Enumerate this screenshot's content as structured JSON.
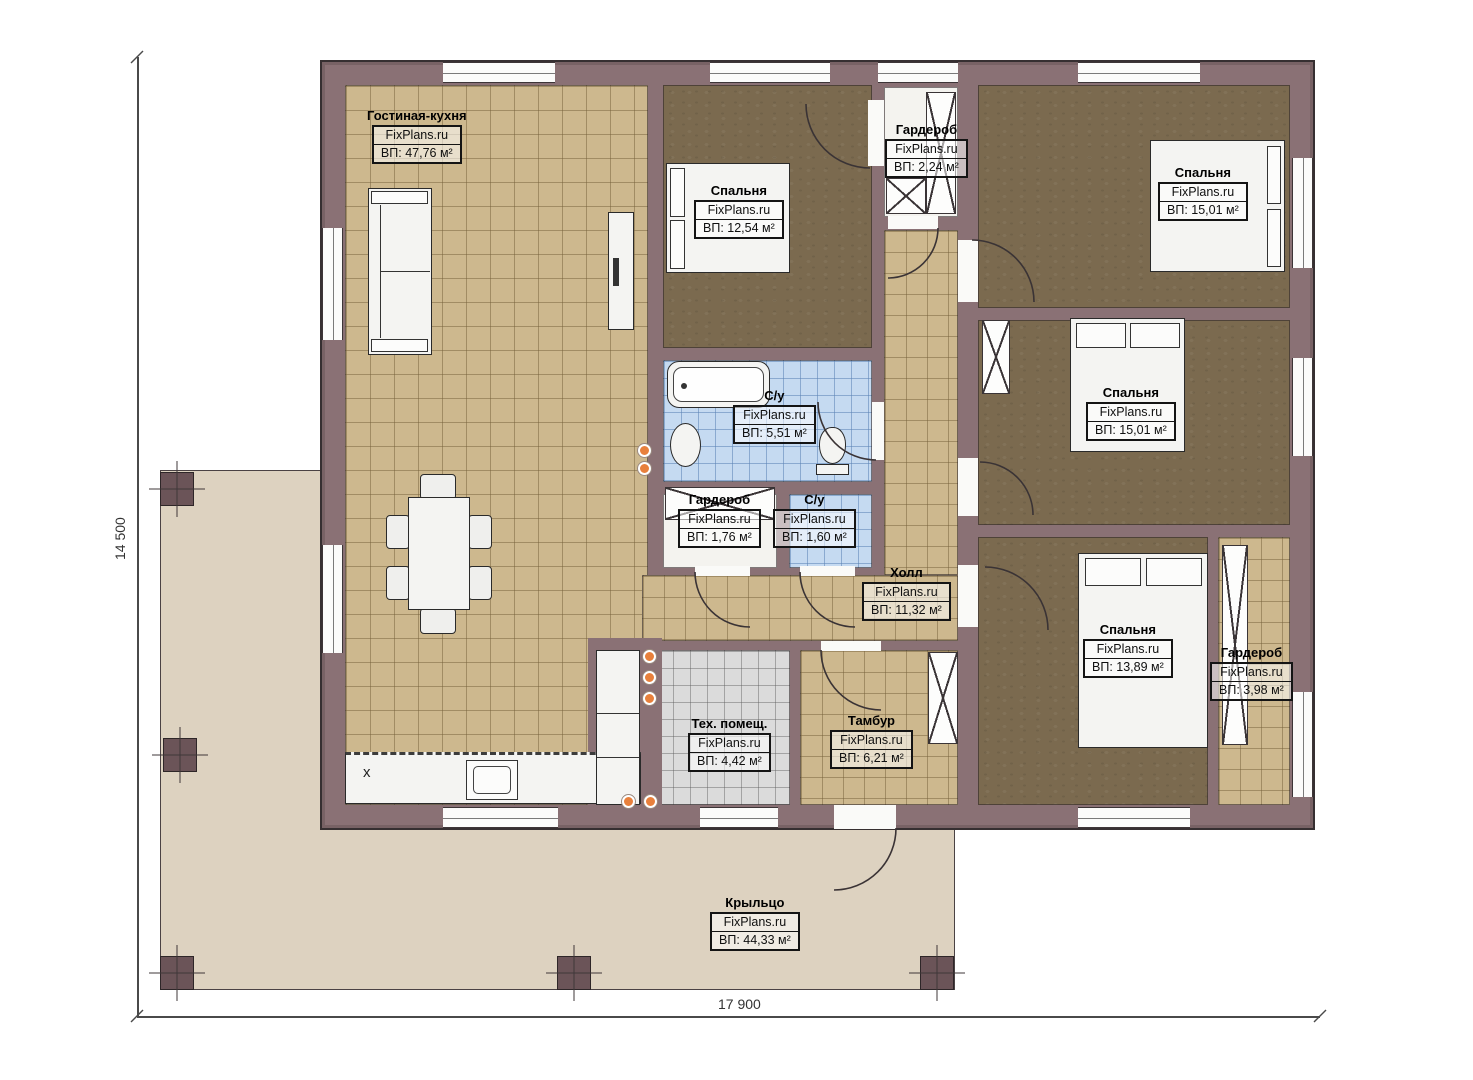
{
  "brand": "FixPlans.ru",
  "dimensions": {
    "height": "14 500",
    "width": "17 900"
  },
  "kitchen_mark": "х",
  "rooms": [
    {
      "id": "living",
      "name": "Гостиная-кухня",
      "brand": "FixPlans.ru",
      "area": "ВП: 47,76 м²"
    },
    {
      "id": "bedroom1",
      "name": "Спальня",
      "brand": "FixPlans.ru",
      "area": "ВП: 12,54 м²"
    },
    {
      "id": "wardrobe1",
      "name": "Гардероб",
      "brand": "FixPlans.ru",
      "area": "ВП: 2,24 м²"
    },
    {
      "id": "bedroom2",
      "name": "Спальня",
      "brand": "FixPlans.ru",
      "area": "ВП: 15,01 м²"
    },
    {
      "id": "bedroom3",
      "name": "Спальня",
      "brand": "FixPlans.ru",
      "area": "ВП: 15,01 м²"
    },
    {
      "id": "bath1",
      "name": "С/у",
      "brand": "FixPlans.ru",
      "area": "ВП: 5,51 м²"
    },
    {
      "id": "wardrobe2",
      "name": "Гардероб",
      "brand": "FixPlans.ru",
      "area": "ВП: 1,76 м²"
    },
    {
      "id": "bath2",
      "name": "С/у",
      "brand": "FixPlans.ru",
      "area": "ВП: 1,60 м²"
    },
    {
      "id": "hall",
      "name": "Холл",
      "brand": "FixPlans.ru",
      "area": "ВП: 11,32 м²"
    },
    {
      "id": "bedroom4",
      "name": "Спальня",
      "brand": "FixPlans.ru",
      "area": "ВП: 13,89 м²"
    },
    {
      "id": "wardrobe3",
      "name": "Гардероб",
      "brand": "FixPlans.ru",
      "area": "ВП: 3,98 м²"
    },
    {
      "id": "tech",
      "name": "Тех. помещ.",
      "brand": "FixPlans.ru",
      "area": "ВП: 4,42 м²"
    },
    {
      "id": "tambur",
      "name": "Тамбур",
      "brand": "FixPlans.ru",
      "area": "ВП: 6,21 м²"
    },
    {
      "id": "porch",
      "name": "Крыльцо",
      "brand": "FixPlans.ru",
      "area": "ВП: 44,33 м²"
    }
  ],
  "colors": {
    "wall": "#8a7175",
    "living_floor": "#cdb88e",
    "bedroom_floor": "#7b6a4f",
    "bath_floor": "#c5daf1",
    "tech_floor": "#dbdbdb",
    "porch_floor": "#ddd2c0",
    "outlet": "#e8803c"
  }
}
